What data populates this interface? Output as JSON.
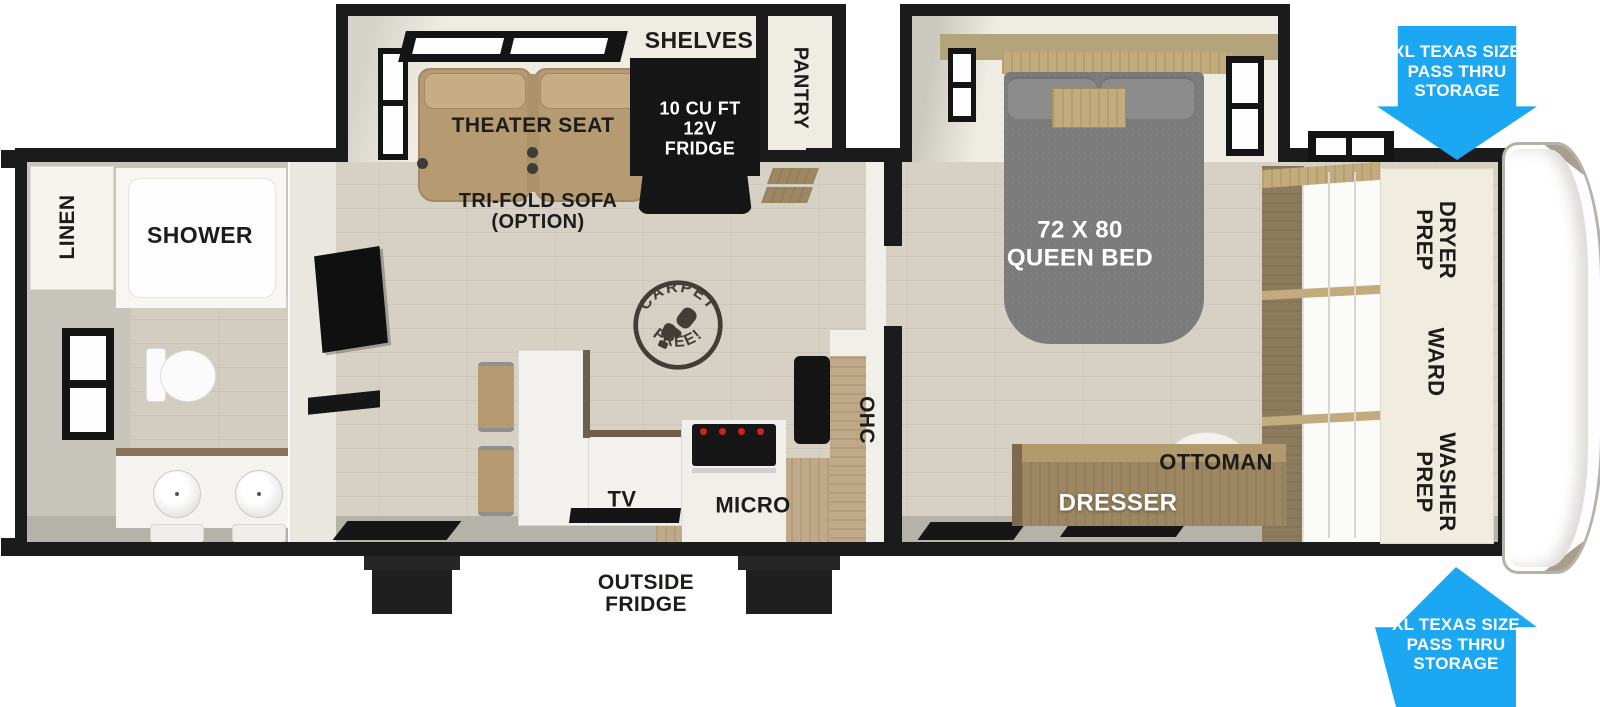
{
  "title": "RV travel trailer floor plan",
  "labels": {
    "linen": "LINEN",
    "shower": "SHOWER",
    "shelves": "SHELVES",
    "pantry": "PANTRY",
    "fridge": "10 CU FT\n12V\nFRIDGE",
    "theater_seat": "THEATER SEAT",
    "trifold_sofa": "TRI-FOLD SOFA\n(OPTION)",
    "carpet_free_top": "CARPET",
    "carpet_free_bottom": "FREE!",
    "tv": "TV",
    "micro": "MICRO",
    "ohc": "OHC",
    "queen_bed": "72 X 80\nQUEEN BED",
    "dresser": "DRESSER",
    "ottoman": "OTTOMAN",
    "dryer_prep": "DRYER\nPREP",
    "ward": "WARD",
    "washer_prep": "WASHER\nPREP",
    "outside_fridge": "OUTSIDE\nFRIDGE",
    "pass_thru_top": "XL TEXAS SIZE\nPASS THRU\nSTORAGE",
    "pass_thru_bottom": "XL TEXAS SIZE\nPASS THRU\nSTORAGE"
  },
  "colors": {
    "wall_black": "#1b1b1b",
    "floor_wood": "#d6d0c5",
    "bath_gray": "#c7c4bb",
    "slide_cream": "#efece4",
    "seat_tan": "#b59a72",
    "bed_gray": "#7b7b7b",
    "wood_medium": "#c2ab7c",
    "counter_wood": "#bfa988",
    "dresser_wood": "#9c8762",
    "panel_cream": "#f0ecdf",
    "arrow_blue": "#1ba7f1",
    "band_gray": "#b5b2aa",
    "cap_taupe": "#a79e91"
  }
}
